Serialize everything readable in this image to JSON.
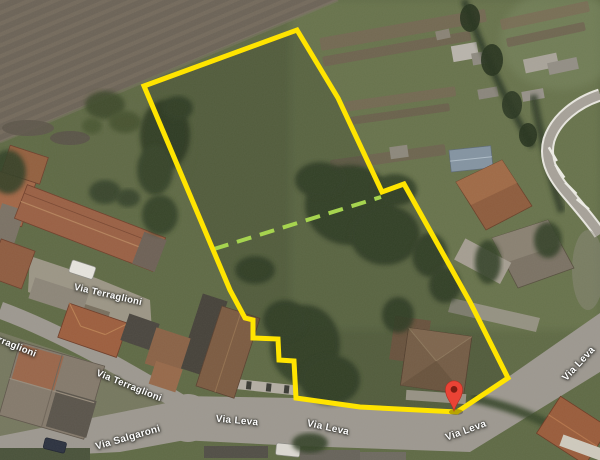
{
  "roads": {
    "terraglioni_upper": "Via Terraglioni",
    "terraglioni_partial": "Terraglioni",
    "terraglioni_lower": "Via Terraglioni",
    "salgaroni": "Via Salgaroni",
    "leva_west": "Via Leva",
    "leva_center": "Via Leva",
    "leva_east": "Via Leva",
    "leva_north": "Via Leva"
  },
  "overlay": {
    "parcel_outline_color": "#FFE400",
    "divider_color": "#A6D44F",
    "pin_color": "#EA4335",
    "pin_inner_color": "#7E1D12"
  }
}
